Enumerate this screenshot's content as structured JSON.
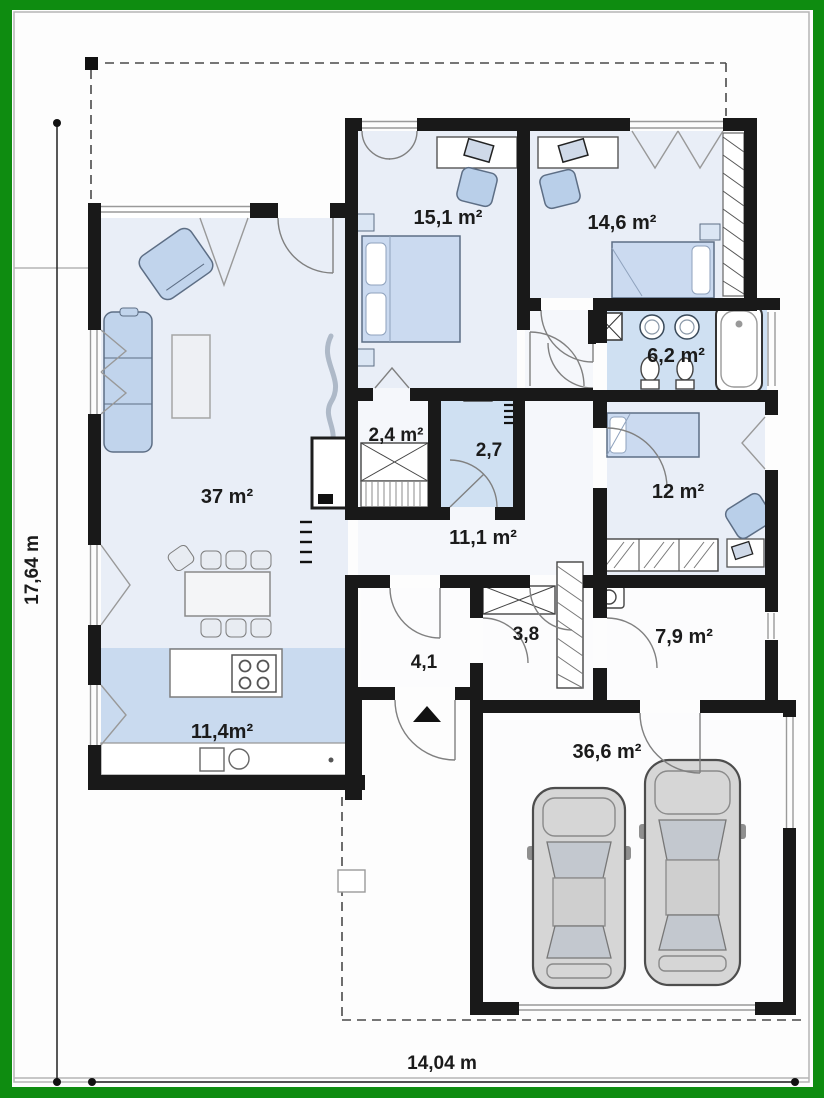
{
  "plan": {
    "colors": {
      "border_green": "#0e8c10",
      "wall": "#191919",
      "room_light": "#e9eef7",
      "room_blue": "#cfe0f2",
      "kitchen_blue": "#c9daef",
      "furniture_blue": "#c1d4ec",
      "car_gray": "#d6d6d6"
    },
    "rooms": [
      {
        "name": "living-room",
        "area": "37 m²"
      },
      {
        "name": "kitchen",
        "area": "11,4m²"
      },
      {
        "name": "bedroom-1",
        "area": "15,1 m²"
      },
      {
        "name": "bedroom-2",
        "area": "14,6 m²"
      },
      {
        "name": "bathroom",
        "area": "6,2 m²"
      },
      {
        "name": "wardrobe",
        "area": "2,4 m²"
      },
      {
        "name": "wc",
        "area": "2,7"
      },
      {
        "name": "hall",
        "area": "11,1 m²"
      },
      {
        "name": "bedroom-3",
        "area": "12 m²"
      },
      {
        "name": "entry",
        "area": "4,1"
      },
      {
        "name": "corridor",
        "area": "3,8"
      },
      {
        "name": "utility",
        "area": "7,9 m²"
      },
      {
        "name": "garage",
        "area": "36,6 m²"
      }
    ],
    "dimensions": {
      "height": "17,64 m",
      "width": "14,04 m"
    }
  }
}
